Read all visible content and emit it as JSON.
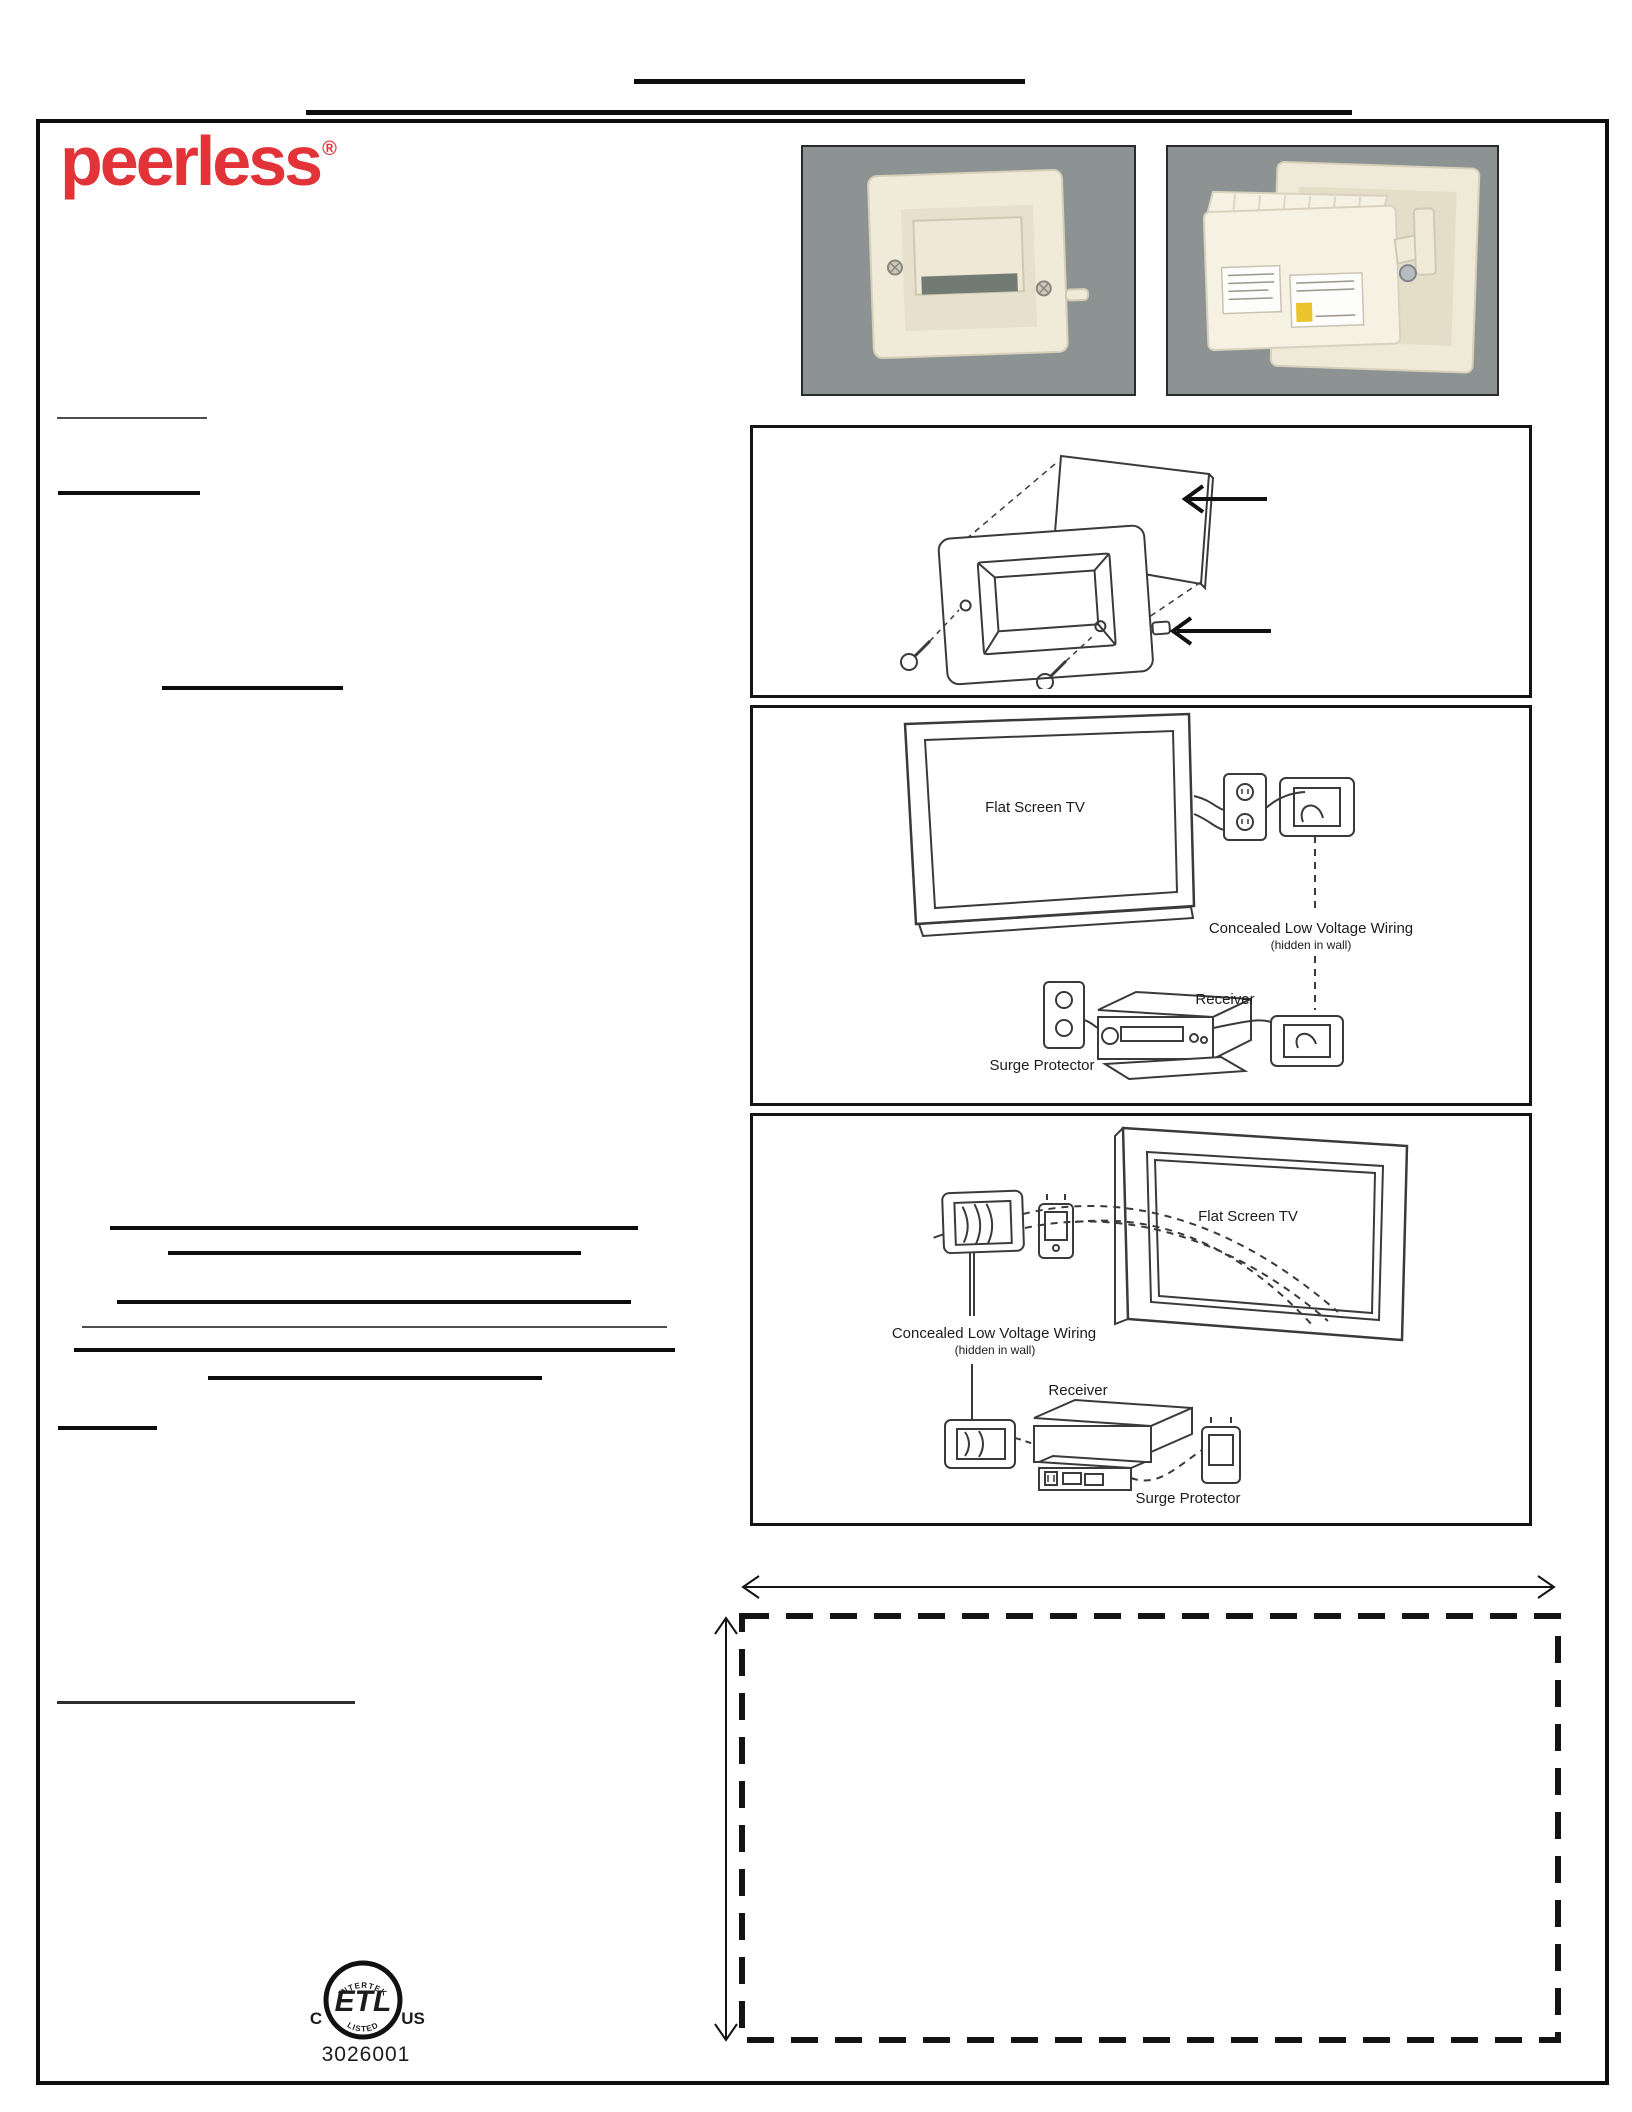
{
  "brand": {
    "name": "peerless",
    "reg": "®",
    "color": "#e23339"
  },
  "diagram_labels": {
    "flat_screen_tv": "Flat Screen TV",
    "concealed_wiring": "Concealed Low Voltage Wiring",
    "hidden_in_wall": "(hidden in wall)",
    "receiver": "Receiver",
    "surge_protector": "Surge Protector"
  },
  "certification": {
    "intertek": "INTERTEK",
    "etl": "ETL",
    "listed": "LISTED",
    "c": "C",
    "us": "US",
    "number": "3026001"
  },
  "colors": {
    "photo_background": "#8c9392",
    "plate_ivory": "#f0ead9",
    "label_yellow": "#e9c42d",
    "line_black": "#141414",
    "brand_red": "#e23339"
  }
}
